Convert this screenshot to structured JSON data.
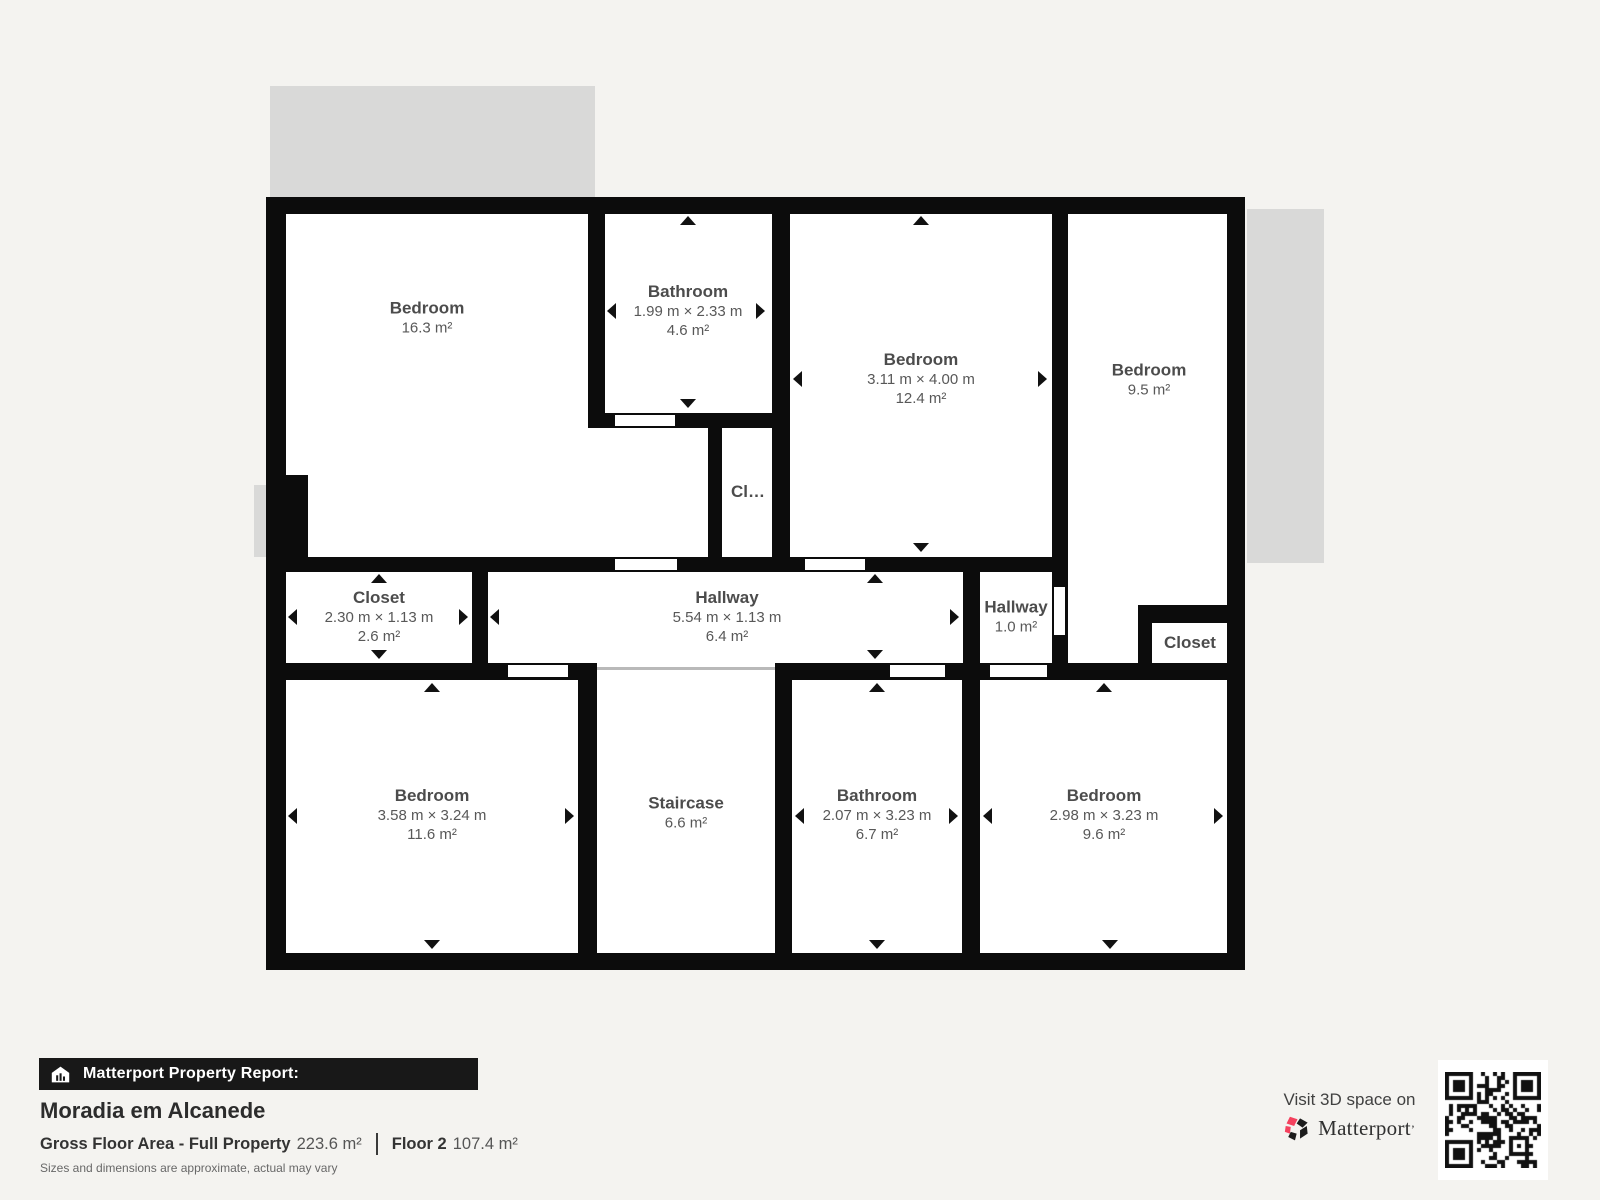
{
  "plan": {
    "rooms": [
      {
        "name": "Bedroom",
        "area": "16.3 m²"
      },
      {
        "name": "Bathroom",
        "dims": "1.99 m × 2.33 m",
        "area": "4.6 m²"
      },
      {
        "name": "Bedroom",
        "dims": "3.11 m × 4.00 m",
        "area": "12.4 m²"
      },
      {
        "name": "Bedroom",
        "area": "9.5 m²"
      },
      {
        "name": "Cl…"
      },
      {
        "name": "Closet",
        "dims": "2.30 m × 1.13 m",
        "area": "2.6 m²"
      },
      {
        "name": "Hallway",
        "dims": "5.54 m × 1.13 m",
        "area": "6.4 m²"
      },
      {
        "name": "Hallway",
        "area": "1.0 m²"
      },
      {
        "name": "Closet"
      },
      {
        "name": "Bedroom",
        "dims": "3.58 m × 3.24 m",
        "area": "11.6 m²"
      },
      {
        "name": "Staircase",
        "area": "6.6 m²"
      },
      {
        "name": "Bathroom",
        "dims": "2.07 m × 3.23 m",
        "area": "6.7 m²"
      },
      {
        "name": "Bedroom",
        "dims": "2.98 m × 3.23 m",
        "area": "9.6 m²"
      }
    ]
  },
  "footer": {
    "report_label": "Matterport Property Report:",
    "property_name": "Moradia em Alcanede",
    "gross_area_label": "Gross Floor Area - Full Property",
    "gross_area_value": "223.6 m²",
    "floor_label": "Floor 2",
    "floor_area_value": "107.4 m²",
    "disclaimer": "Sizes and dimensions are approximate, actual may vary",
    "visit_label": "Visit 3D space on",
    "brand_name": "Matterport",
    "brand_mark": "’"
  },
  "icons": {
    "report_bar_icon": "house-chart-icon",
    "brand_icon": "matterport-pinwheel-icon",
    "qr": "qr-code"
  },
  "colors": {
    "background": "#f4f3f0",
    "wall": "#0c0c0c",
    "room": "#ffffff",
    "deck": "#d9d9d8",
    "brand_red": "#f4415e",
    "bar_background": "#181818"
  }
}
